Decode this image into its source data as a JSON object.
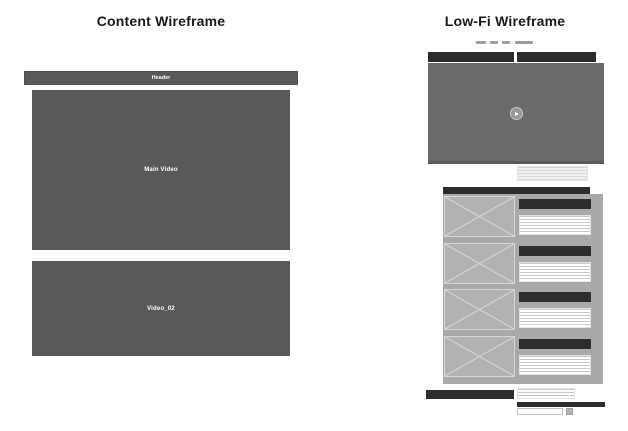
{
  "colors": {
    "canvas_bg": "#ffffff",
    "box_dark": "#595959",
    "video_gray": "#6b6b6b",
    "bar_dark": "#2d2d2d",
    "panel_gray": "#a9a9a9",
    "placeholder_gray": "#b2b2b2",
    "placeholder_line": "#d6d6d6",
    "dash_gray": "#9c9c9c",
    "title_text": "#1a1a1a",
    "label_text": "#ffffff"
  },
  "content_panel": {
    "title": "Content Wireframe",
    "header_label": "Header",
    "main_video_label": "Main Video",
    "secondary_video_label": "Video_02"
  },
  "lowfi_panel": {
    "title": "Low-Fi Wireframe",
    "nav_item_count": 4,
    "list_item_count": 4,
    "play_icon": "play-icon"
  }
}
